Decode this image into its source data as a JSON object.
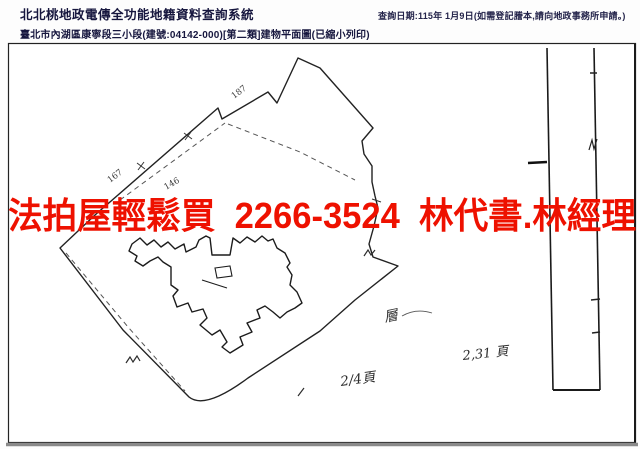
{
  "header": {
    "system_title": "北北桃地政電傳全功能地籍資料查詢系統",
    "document_title": "臺北市內湖區康寧段三小段(建號:04142-000)[第二類]建物平面圖(已縮小列印)",
    "query_date": "查詢日期:115年 1月9日(如需登記謄本,請向地政事務所申請。)"
  },
  "overlay": {
    "ad_text": "法拍屋輕鬆買  2266-3524  林代書.林經理",
    "ad_color": "#ee1100"
  },
  "drawing": {
    "ink_color": "#222222",
    "parcel_labels": [
      {
        "text": "187"
      },
      {
        "text": "167"
      },
      {
        "text": "146"
      }
    ],
    "annotations": {
      "floor_note": "層",
      "hand_page_ref": "2,31 頁",
      "page_number": "2/4頁"
    }
  }
}
